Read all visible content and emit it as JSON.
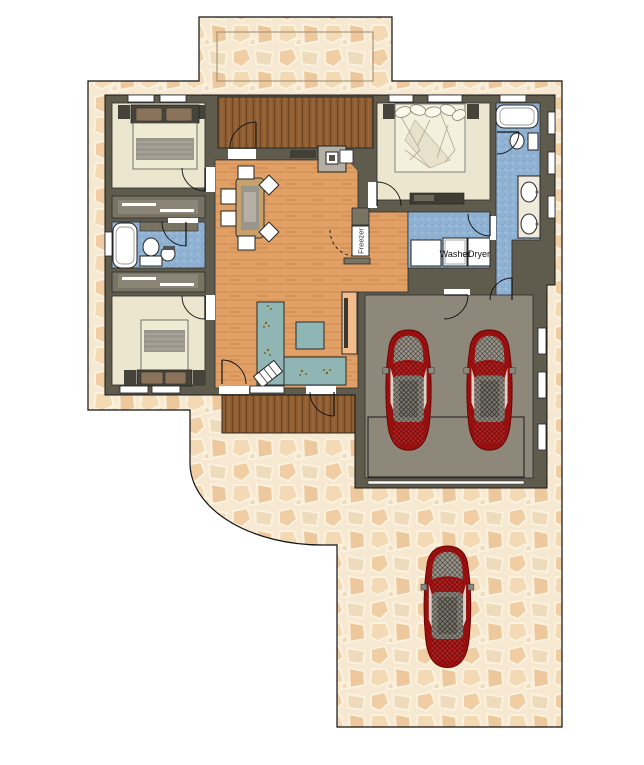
{
  "plan": {
    "labels": {
      "washer": "Washer",
      "dryer": "Dryer",
      "freezer": "Freezer"
    },
    "colors": {
      "stone-base": "#f7e8d2",
      "stone-1": "#f1cda4",
      "stone-2": "#eedbbc",
      "stone-3": "#f3d9b4",
      "stone-4": "#eec89d",
      "wall": "#5f5b4d",
      "wall-light": "#787363",
      "wood-floor": "#e1a166",
      "wood-grain": "#cf8b4f",
      "deck": "#8f5e33",
      "deck-line": "#70451f",
      "cream": "#ebe6cd",
      "blue-tile": "#8fb1d2",
      "blue-grid": "#7697bd",
      "counter": "#8fb5b4",
      "pantry": "#f2bc8d",
      "garage": "#8d887a",
      "car-red": "#a31111",
      "car-accent": "#b32020",
      "car-gray": "#8e897e",
      "outline": "#1a1a1a"
    },
    "cars": {
      "garage_count": 2,
      "driveway_count": 1
    }
  }
}
